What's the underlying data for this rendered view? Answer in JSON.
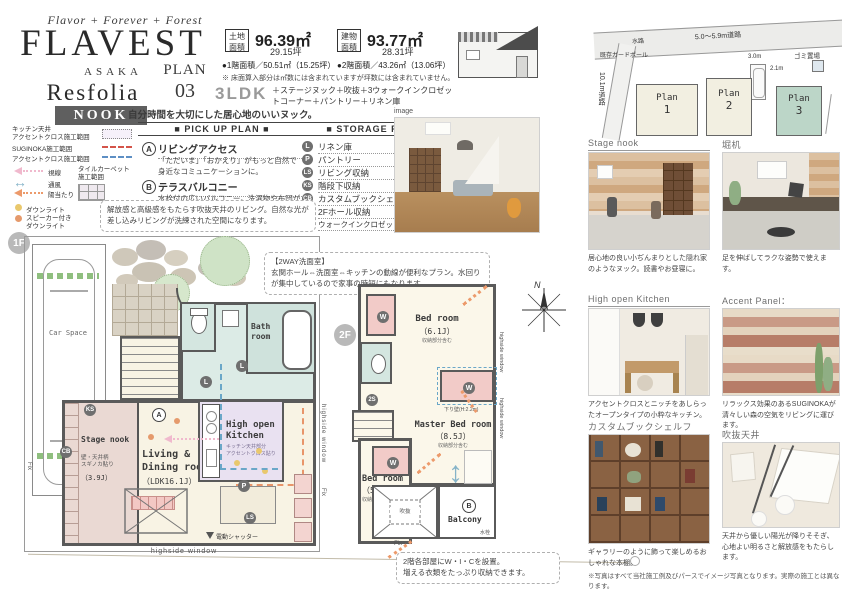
{
  "header": {
    "script_tagline": "Flavor + Forever + Forest",
    "brand": "FLAVEST",
    "location": "ASAKA",
    "series": "Resfolia",
    "badge": "NOOK",
    "plan_label": "PLAN",
    "plan_number": "03",
    "tagline": "自分時間を大切にした居心地のいいヌック。"
  },
  "area": {
    "land_label": "土地面積",
    "land_sqm": "96.39㎡",
    "land_tsubo": "29.15坪",
    "bldg_label": "建物面積",
    "bldg_sqm": "93.77㎡",
    "bldg_tsubo": "28.31坪",
    "floor1": "●1階面積／50.51㎡（15.25坪）",
    "floor2": "●2階面積／43.26㎡（13.06坪）",
    "note": "※ 床面算入部分は㎡数には含まれていますが坪数には含まれていません。",
    "ldk": "3LDK",
    "features": "＋ステージヌック＋吹抜＋3ウォークインクロゼットコーナー＋パントリー＋リネン庫"
  },
  "site": {
    "road_top": "5.0〜5.9m道路",
    "road_left": "10.1m道路",
    "guard_pole": "既存ガードポール",
    "waterway": "水路",
    "trash": "ゴミ置場",
    "dim_a": "3.0m",
    "dim_b": "2.1m",
    "plans": [
      {
        "label": "Plan",
        "num": "1"
      },
      {
        "label": "Plan",
        "num": "2"
      },
      {
        "label": "Plan",
        "num": "3"
      }
    ]
  },
  "legend": {
    "kitchen_l1": "キッチン天井",
    "kitchen_l2": "アクセントクロス施工範囲",
    "suginoka": "SUGINOKA施工範囲",
    "accent": "アクセントクロス施工範囲",
    "sight": "視線",
    "airflow": "通風",
    "sunlight": "陽当たり",
    "downlight": "ダウンライト",
    "speaker_l1": "スピーカー付き",
    "speaker_l2": "ダウンライト",
    "tile_l1": "タイルカーペット",
    "tile_l2": "施工範囲"
  },
  "pickup": {
    "title": "■ PICK UP PLAN ■",
    "items": [
      {
        "key": "A",
        "label": "リビングアクセス",
        "desc": "「ただいま」「おかえり」がもっと自然で身近なコミュニケーションに。"
      },
      {
        "key": "B",
        "label": "テラスバルコニー",
        "desc": "水栓付の広いバルコニー。洗濯物や布団がたっぷり干せます。"
      }
    ]
  },
  "storage": {
    "title": "■ STORAGE PLAN ■",
    "items": [
      {
        "key": "L",
        "label": "リネン庫"
      },
      {
        "key": "P",
        "label": "パントリー"
      },
      {
        "key": "LS",
        "label": "リビング収納"
      },
      {
        "key": "KS",
        "label": "階段下収納"
      },
      {
        "key": "CB",
        "label": "カスタムブックシェルフ"
      },
      {
        "key": "2S",
        "label": "2Fホール収納"
      },
      {
        "key": "W",
        "label": "ウォークインクロゼットコーナー"
      }
    ]
  },
  "notes": {
    "living": "解放感と高級感をもたらす吹抜天井のリビング。自然な光が差し込みリビングが洗練された空間になります。",
    "twoway_title": "【2WAY洗面室】",
    "twoway_body": "玄関ホール⇔洗面室⇔キッチンの動線が便利なプラン。水回りが集中しているので家事の時短にもなります。",
    "wic_l1": "2階各部屋にW・I・Cを設置。",
    "wic_l2": "増える衣類をたっぷり収納できます。",
    "disclaimer": "※写真はすべて当社施工例及びパースでイメージ写真となります。実際の施工とは異なります。"
  },
  "f1": {
    "badge": "1F",
    "car": "Car Space",
    "bath": "Bath room",
    "nook": "Stage nook",
    "nook_note1": "壁・天井柄",
    "nook_note2": "スギノカ貼り",
    "nook_size": "（3.9J）",
    "living1": "Living &",
    "living2": "Dining room",
    "living_size": "（LDK16.1J）",
    "kitchen1": "High open",
    "kitchen2": "Kitchen",
    "kitchen_note1": "キッチン天井部分",
    "kitchen_note2": "アクセントクロス貼り",
    "highside": "highside window",
    "fix": "Fix",
    "shutter": "電動シャッター"
  },
  "f2": {
    "badge": "2F",
    "bed1": "Bed room",
    "bed1_size": "（6.1J）",
    "incl_note": "収納部分含む",
    "master": "Master Bed room",
    "master_size": "（8.5J）",
    "bed2": "Bed room",
    "bed2_size": "（5.5J）",
    "void": "吹抜",
    "fix": "Fix",
    "balcony": "Balcony",
    "faucet": "水栓",
    "drop_wall": "下り壁(H:2.2m)",
    "highside": "highside window",
    "compass_n": "N"
  },
  "gallery": {
    "image_label": "image",
    "items": [
      {
        "title": "Stage nook",
        "caption": "居心地の良い小ぢんまりとした隠れ家のようなヌック。読書やお昼寝に。"
      },
      {
        "title": "堀机",
        "caption": "足を伸ばしてラクな姿勢で使えます。"
      },
      {
        "title": "High open Kitchen",
        "caption": "アクセントクロスとニッチをあしらったオープンタイプの小粋なキッチン。"
      },
      {
        "title": "Accent Panel：SUGINOKA",
        "caption": "リラックス効果のあるSUGINOKAが清々しい森の空気をリビングに運びます。"
      },
      {
        "title": "カスタムブックシェルフ",
        "caption": "ギャラリーのように飾って楽しめるおしゃれな本棚。"
      },
      {
        "title": "吹抜天井",
        "caption": "天井から優しい陽光が降りそそぎ、心地よい明るさと解放感をもたらします。"
      }
    ]
  },
  "colors": {
    "badge_bg": "#5f5f5f",
    "plan3_green": "#bcd6c8",
    "closet_pink": "#f2cbc8",
    "bath_teal": "#d8e8e3",
    "kitchen_purple": "#e9e1f1",
    "room_cream": "#faf5e6",
    "arrow_orange": "#ec9a6b",
    "arrow_blue": "#85b3c8",
    "arrow_pink": "#f0b9cd"
  }
}
